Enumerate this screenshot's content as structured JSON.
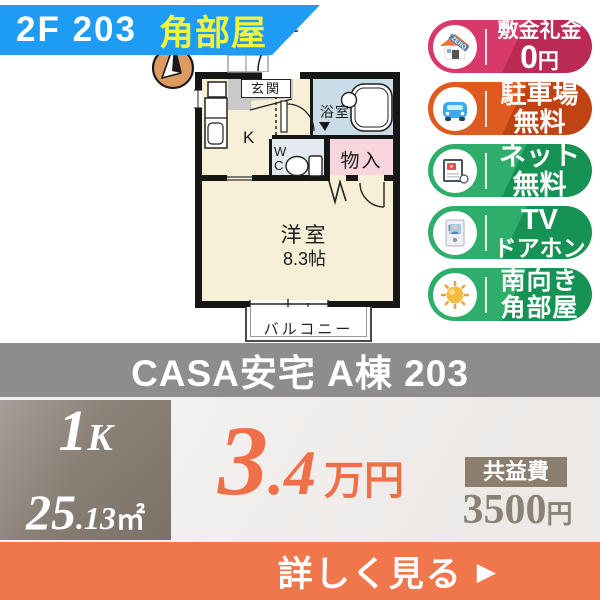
{
  "banner": {
    "unit": "2F 203",
    "corner": "角部屋"
  },
  "compass": {
    "north": "N"
  },
  "floorplan": {
    "genkan": "玄関",
    "kitchen": "K",
    "bath": "浴室",
    "wc_line1": "W",
    "wc_line2": "C",
    "storage": "物入",
    "main_room": "洋室",
    "main_size": "8.3帖",
    "balcony": "バルコニー"
  },
  "badges": [
    {
      "id": "deposit-key-money-zero",
      "line1": "敷金礼金",
      "zero": "0",
      "zero_unit": "円",
      "ribbon": "ZERO"
    },
    {
      "id": "parking-free",
      "line1": "駐車場",
      "line2": "無料"
    },
    {
      "id": "internet-free",
      "line1": "ネット",
      "line2": "無料"
    },
    {
      "id": "tv-doorphone",
      "line1": "TV",
      "line2": "ドアホン"
    },
    {
      "id": "south-corner",
      "line1": "南向き",
      "line2": "角部屋"
    }
  ],
  "title": "CASA安宅 A棟 203",
  "summary": {
    "layout_num": "1",
    "layout_unit": "K",
    "area_int": "25",
    "area_dec": ".13",
    "area_unit": "㎡"
  },
  "price": {
    "yen_int": "3",
    "yen_dec": ".4",
    "yen_unit": "万円",
    "fee_label": "共益費",
    "fee_value": "3500",
    "fee_unit": "円"
  },
  "cta": {
    "label": "詳しく見る",
    "arrow": "▶"
  },
  "colors": {
    "banner_blue": "#1e9bf2",
    "corner_yellow": "#f2f43a",
    "badge_pink": "#d8396b",
    "badge_pink_dark": "#bb2a55",
    "badge_orange": "#df5a20",
    "badge_orange_dark": "#c04413",
    "badge_green": "#2fae6b",
    "badge_green_dark": "#169254",
    "title_gray": "#8d8d8d",
    "box_taupe": "#958c83",
    "box_taupe_dark": "#7b7167",
    "price_orange": "#ef7048",
    "fee_taupe": "#8b7e6f",
    "fee_text": "#8b8174",
    "bar_orange": "#f0764b",
    "plan_cream": "#f7efd6",
    "plan_gray": "#c9c9c9",
    "bath_blue": "#cbdce9",
    "wc_blue": "#e3ebf1",
    "storage_pink": "#f8d5dc"
  }
}
